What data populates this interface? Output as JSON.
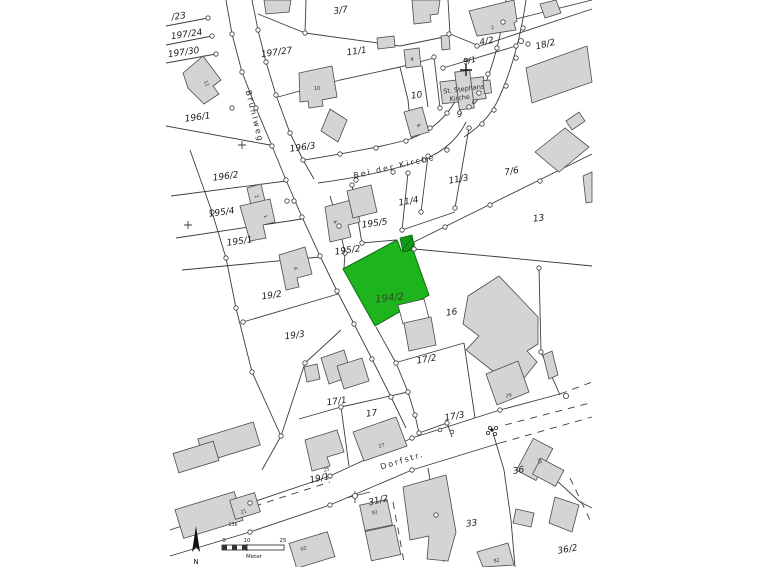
{
  "map": {
    "type": "cadastral-parcel-map",
    "colors": {
      "background": "#ffffff",
      "line": "#3c3c3c",
      "building_fill": "#d4d4d4",
      "highlight_fill": "#1db41d",
      "highlight_hatch": "#13991a"
    },
    "highlighted_parcel": "194/2",
    "streets": [
      {
        "name": "Brühlweg"
      },
      {
        "name": "Bei der Kirche"
      },
      {
        "name": "Dorfstr."
      }
    ],
    "church": {
      "name_line1": "St. Stephans",
      "name_line2": "Kirche",
      "point_number": "65",
      "house_number": "6"
    },
    "parcels": [
      {
        "label": "/23"
      },
      {
        "label": "197/24"
      },
      {
        "label": "197/30"
      },
      {
        "label": "197/27"
      },
      {
        "label": "3/7"
      },
      {
        "label": "11/1"
      },
      {
        "label": "196/1"
      },
      {
        "label": "196/3"
      },
      {
        "label": "196/2"
      },
      {
        "label": "195/4"
      },
      {
        "label": "195/1"
      },
      {
        "label": "19/2"
      },
      {
        "label": "195/5"
      },
      {
        "label": "195/2"
      },
      {
        "label": "11/3"
      },
      {
        "label": "11/4"
      },
      {
        "label": "7/6"
      },
      {
        "label": "13"
      },
      {
        "label": "4/2"
      },
      {
        "label": "18/2"
      },
      {
        "label": "9/1"
      },
      {
        "label": "9"
      },
      {
        "label": "10"
      },
      {
        "label": "194/2"
      },
      {
        "label": "16"
      },
      {
        "label": "17/2"
      },
      {
        "label": "19/3"
      },
      {
        "label": "17/1"
      },
      {
        "label": "17"
      },
      {
        "label": "17/3"
      },
      {
        "label": "19/1"
      },
      {
        "label": "31/2"
      },
      {
        "label": "36"
      },
      {
        "label": "33"
      },
      {
        "label": "36/2"
      }
    ],
    "building_numbers": [
      {
        "label": "11"
      },
      {
        "label": "10"
      },
      {
        "label": "2"
      },
      {
        "label": "4"
      },
      {
        "label": "8"
      },
      {
        "label": "2"
      },
      {
        "label": "1"
      },
      {
        "label": "4"
      },
      {
        "label": "4"
      },
      {
        "label": "27"
      },
      {
        "label": "25"
      },
      {
        "label": "21"
      },
      {
        "label": "136"
      },
      {
        "label": "92"
      },
      {
        "label": "92"
      },
      {
        "label": "29"
      },
      {
        "label": "30"
      },
      {
        "label": "82"
      }
    ],
    "scalebar": {
      "ticks": [
        "0",
        "10",
        "25"
      ],
      "unit": "Meter"
    },
    "north_label": "N"
  }
}
